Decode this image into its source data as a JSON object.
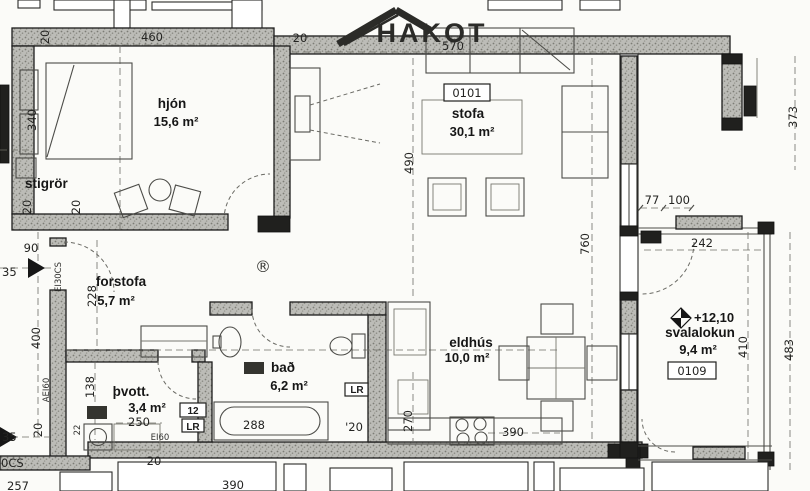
{
  "logo": {
    "text": "HAKOT"
  },
  "rooms": {
    "hjon": {
      "name": "hjón",
      "area": "15,6 m²"
    },
    "stigror": {
      "name": "stigrör"
    },
    "stofa": {
      "name": "stofa",
      "area": "30,1 m²",
      "code": "0101"
    },
    "forstofa": {
      "name": "forstofa",
      "area": "5,7 m²"
    },
    "tvott": {
      "name": "þvott.",
      "area": "3,4 m²"
    },
    "bad": {
      "name": "bað",
      "area": "6,2 m²"
    },
    "eldhus": {
      "name": "eldhús",
      "area": "10,0 m²"
    },
    "svalalokun": {
      "name": "svalalokun",
      "area": "9,4 m²",
      "code": "0109",
      "elevation": "+12,10"
    }
  },
  "dims": {
    "d460": "460",
    "d570": "570",
    "d490": "490",
    "d760": "760",
    "d77": "77",
    "d100": "100",
    "d242": "242",
    "d373": "373",
    "d483": "483",
    "d410": "410",
    "d340": "340",
    "d228": "228",
    "d400": "400",
    "d90": "90",
    "d35": "35",
    "d138": "138",
    "d250": "250",
    "d288": "288",
    "d270": "270",
    "d390": "390",
    "d22": "22",
    "d20": "20",
    "d20_apostrophe": "'20",
    "d257": "257"
  },
  "fire_ratings": {
    "ei30cs": "EI30CS",
    "aei60": "AEI60",
    "ei60": "EI60",
    "ei30cs_fragment": "0CS"
  },
  "tags": {
    "twelve": "12",
    "lr": "LR"
  },
  "symbols": {
    "registered": "®"
  }
}
